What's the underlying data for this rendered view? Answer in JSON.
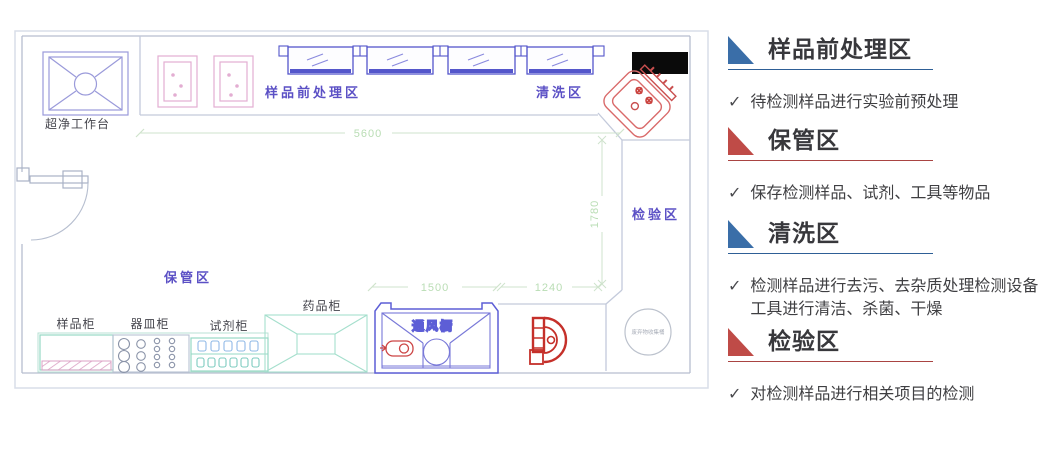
{
  "plan": {
    "labels": {
      "clean_bench": "超净工作台",
      "sample_prep_area": "样品前处理区",
      "washing_area": "清洗区",
      "testing_area": "检验区",
      "storage_area": "保管区",
      "sample_cabinet": "样品柜",
      "vessel_cabinet": "器皿柜",
      "reagent_cabinet": "试剂柜",
      "medicine_cabinet": "药品柜",
      "fume_hood": "通风橱",
      "waste_container": "废弃物收集桶"
    },
    "dimensions": {
      "top_width": "5600",
      "right_height": "1780",
      "fume_hood_width": "1500",
      "corner_width": "1240"
    },
    "colors": {
      "wall": "#b6becf",
      "window_blue": "#5456cb",
      "zone_label_purple": "#5b50c5",
      "cabinet_teal": "#96d8c4",
      "equipment_pink": "#e3aed2",
      "sink_red": "#d96a6a",
      "dimension_green": "#b9ddb4",
      "fume_label_magenta": "#cc44cc"
    }
  },
  "panel": {
    "sections": [
      {
        "title": "样品前处理区",
        "check": "✓",
        "bullet": "待检测样品进行实验前预处理",
        "accent_color": "#3a6ea8",
        "line_color": "#2e5f96"
      },
      {
        "title": "保管区",
        "check": "✓",
        "bullet": "保存检测样品、试剂、工具等物品",
        "accent_color": "#bf4b47",
        "line_color": "#a94442"
      },
      {
        "title": "清洗区",
        "check": "✓",
        "bullet": "检测样品进行去污、去杂质处理检测设备工具进行清洁、杀菌、干燥",
        "accent_color": "#3a6ea8",
        "line_color": "#2e5f96"
      },
      {
        "title": "检验区",
        "check": "✓",
        "bullet": "对检测样品进行相关项目的检测",
        "accent_color": "#bf4b47",
        "line_color": "#a94442"
      }
    ]
  }
}
